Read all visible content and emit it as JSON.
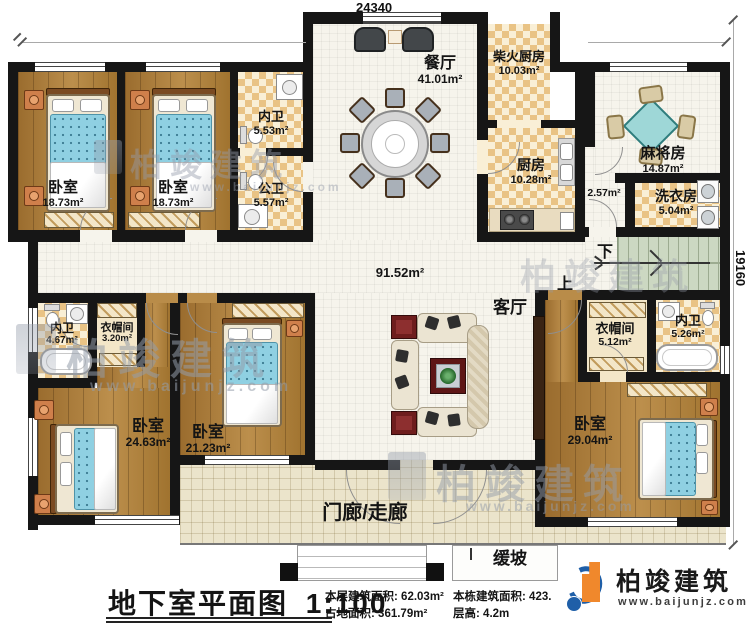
{
  "plan": {
    "title": {
      "text": "地下室平面图",
      "scale": "1:100"
    },
    "dimensions": {
      "width_mm": "24340",
      "depth_mm": "19160"
    },
    "rooms": {
      "bedroom_tl1": {
        "name": "卧室",
        "area": "18.73m²"
      },
      "bedroom_tl2": {
        "name": "卧室",
        "area": "18.73m²"
      },
      "bath_inner_top": {
        "name": "内卫",
        "area": "5.53m²"
      },
      "bath_public": {
        "name": "公卫",
        "area": "5.57m²"
      },
      "dining": {
        "name": "餐厅",
        "area": "41.01m²"
      },
      "firewood_kitchen": {
        "name": "柴火厨房",
        "area": "10.03m²"
      },
      "kitchen": {
        "name": "厨房",
        "area": "10.28m²"
      },
      "passage": {
        "area": "2.57m²"
      },
      "mahjong": {
        "name": "麻将房",
        "area": "14.87m²"
      },
      "laundry": {
        "name": "洗衣房",
        "area": "5.04m²"
      },
      "living": {
        "name": "客厅",
        "area": "91.52m²"
      },
      "cloak_left": {
        "name": "衣帽间",
        "area": "3.20m²"
      },
      "bath_inner_left": {
        "name": "内卫",
        "area": "4.67m²"
      },
      "bedroom_bl": {
        "name": "卧室",
        "area": "24.63m²"
      },
      "bedroom_bm": {
        "name": "卧室",
        "area": "21.23m²"
      },
      "cloak_right": {
        "name": "衣帽间",
        "area": "5.12m²"
      },
      "bath_inner_right": {
        "name": "内卫",
        "area": "5.26m²"
      },
      "bedroom_br": {
        "name": "卧室",
        "area": "29.04m²"
      },
      "porch": {
        "name": "门廊/走廊"
      },
      "ramp": {
        "name": "缓坡"
      }
    },
    "stairs": {
      "down": "下",
      "up": "上"
    },
    "stats": {
      "floor_area_label": "本层建筑面积:",
      "floor_area_value": "62.03m²",
      "footprint_label": "占地面积:",
      "footprint_value": "361.79m²",
      "building_area_label": "本栋建筑面积:",
      "building_area_value": "423.",
      "floor_height_label": "层高:",
      "floor_height_value": "4.2m"
    }
  },
  "branding": {
    "name": "柏竣建筑",
    "website": "www.baijunjz.com",
    "orange": "#f0882c",
    "blue": "#1f5fa8"
  },
  "watermark": {
    "text": "柏竣建筑",
    "website": "www.baijunjz.com"
  }
}
